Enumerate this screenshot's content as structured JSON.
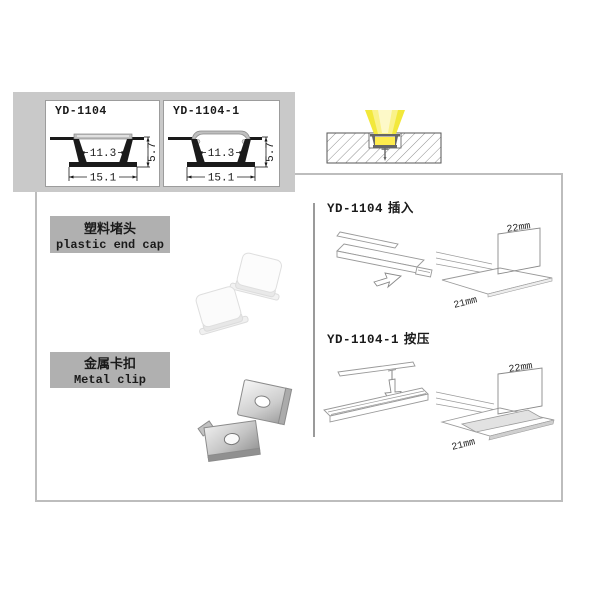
{
  "colors": {
    "panel": "#c9c9c9",
    "labelbox": "#b0b0b0",
    "boxborder": "#bdbdbd",
    "divider": "#9a9a9a",
    "ink": "#1a1a1a",
    "lineart": "#9a9a9a",
    "beam_outer": "#f2e83b",
    "beam_inner": "#faf289",
    "glow": "#ffec4d"
  },
  "spec_panel": {
    "profiles": [
      {
        "model": "YD-1104",
        "inner_width": "11.3",
        "outer_width": "15.1",
        "height": "5.7"
      },
      {
        "model": "YD-1104-1",
        "inner_width": "11.3",
        "outer_width": "15.1",
        "height": "5.7"
      }
    ]
  },
  "accessories": [
    {
      "label_cn": "塑料堵头",
      "label_en": "plastic end cap"
    },
    {
      "label_cn": "金属卡扣",
      "label_en": "Metal clip"
    }
  ],
  "mounting": [
    {
      "model": "YD-1104",
      "method_cn": "插入",
      "dim_height": "22mm",
      "dim_width": "21mm"
    },
    {
      "model": "YD-1104-1",
      "method_cn": "按压",
      "dim_height": "22mm",
      "dim_width": "21mm"
    }
  ]
}
